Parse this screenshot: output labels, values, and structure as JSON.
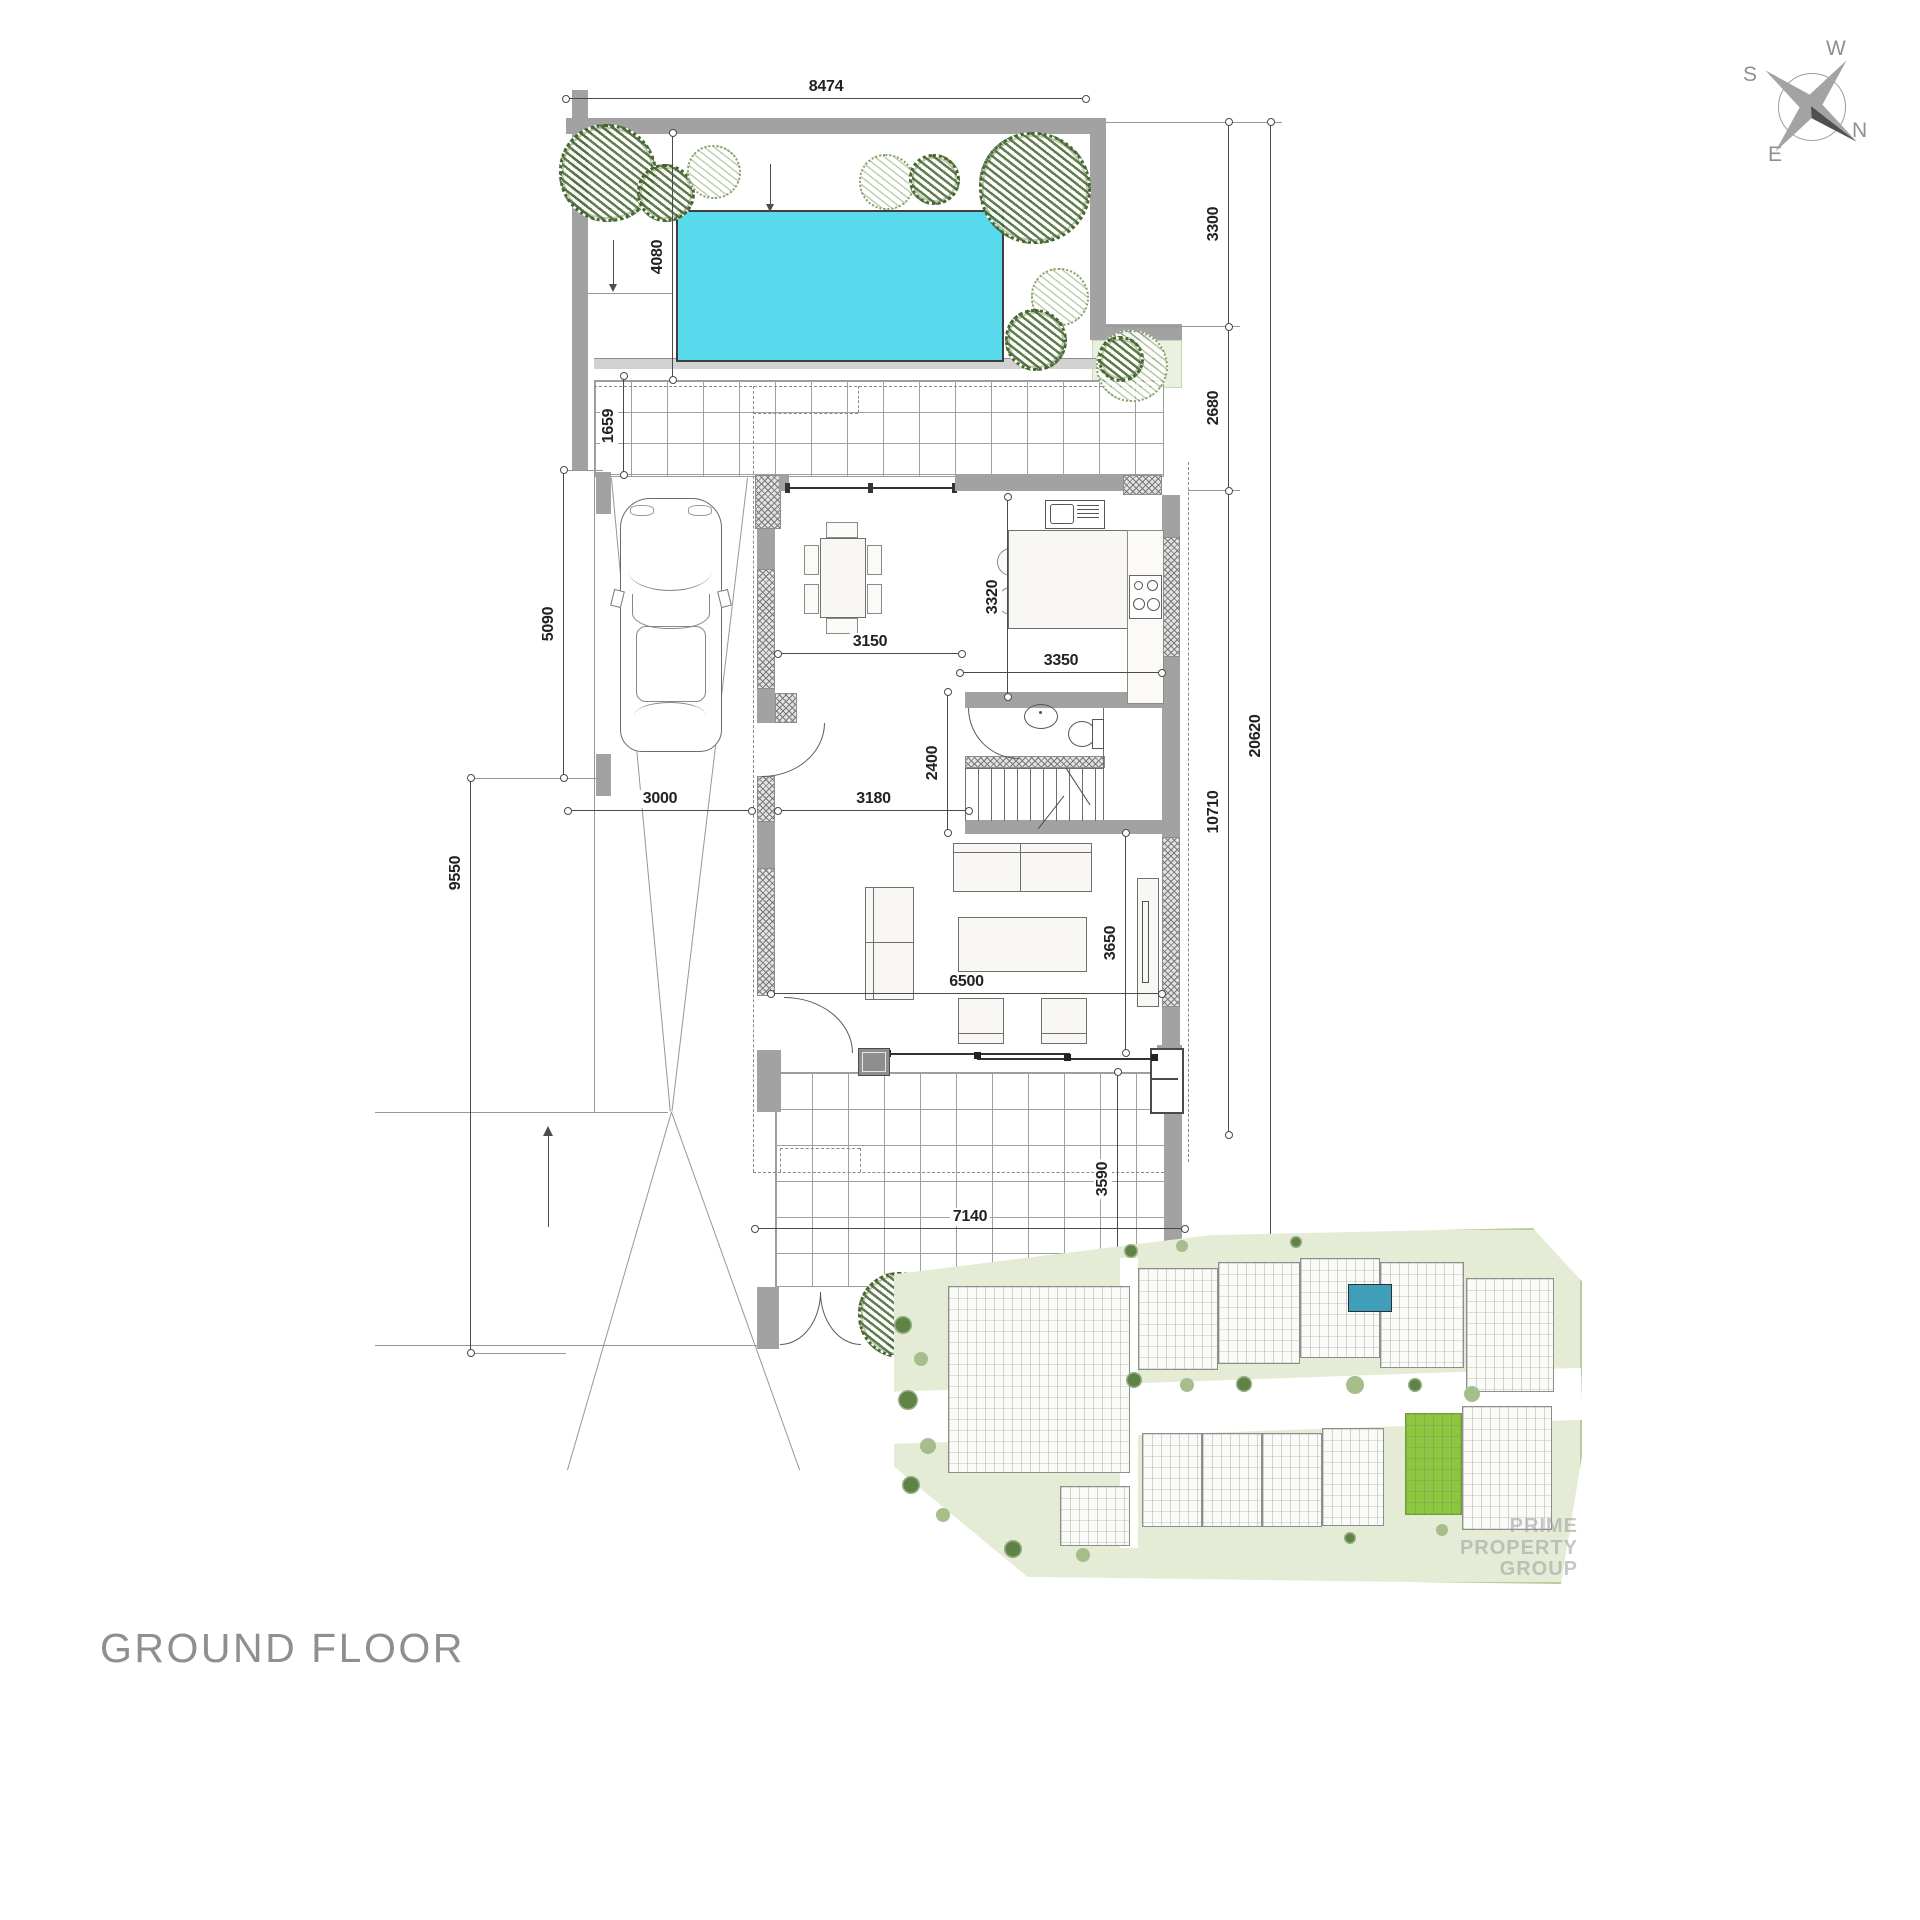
{
  "title": {
    "label": "GROUND FLOOR"
  },
  "compass": {
    "north": "N",
    "south": "S",
    "east": "E",
    "west": "W"
  },
  "colors": {
    "pool": "#59d9ec",
    "wall_gray": "#a2a2a2",
    "dimension_text": "#222222",
    "tree_dark": "#4a6b31",
    "tree_light": "#8ca76f",
    "site_ground": "#e4ecd6",
    "site_highlight": "#8dc63f",
    "title_gray": "#8f8f8f"
  },
  "dimensions": {
    "plot_top_width": "8474",
    "pool_depth": "4080",
    "terrace_north_depth": "1659",
    "carport_depth": "5090",
    "driveway_length": "9550",
    "carport_width": "3000",
    "dining_width": "3150",
    "kitchen_depth": "3320",
    "kitchen_width": "3350",
    "stair_hall_depth": "2400",
    "hall_width": "3180",
    "living_width": "6500",
    "living_depth": "3650",
    "terrace_south_width": "7140",
    "terrace_south_depth": "3590",
    "east_segment_1": "3300",
    "east_segment_2": "2680",
    "east_segment_3": "10710",
    "east_total": "20620"
  },
  "watermark": {
    "text": "PRIME PROPERTY GROUP"
  }
}
